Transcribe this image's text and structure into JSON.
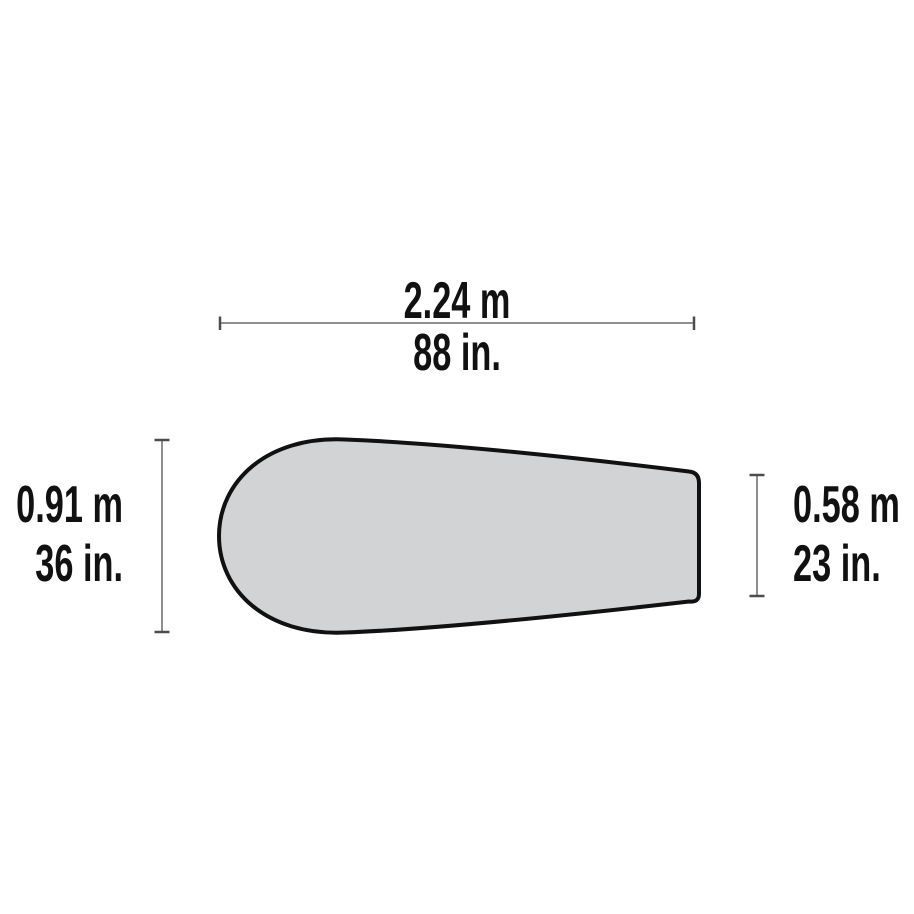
{
  "diagram": {
    "kind": "product-dimension-diagram",
    "labels": {
      "length_metric": "2.24 m",
      "length_imperial": "88 in.",
      "head_width_metric": "0.91 m",
      "head_width_imperial": "36 in.",
      "foot_width_metric": "0.58 m",
      "foot_width_imperial": "23 in."
    },
    "colors": {
      "background": "#ffffff",
      "shape_fill": "#d1d3d4",
      "shape_outline": "#111111",
      "dimension_line": "#8f8f8f",
      "dimension_tick": "#4d4d4d",
      "text": "#111111"
    }
  }
}
